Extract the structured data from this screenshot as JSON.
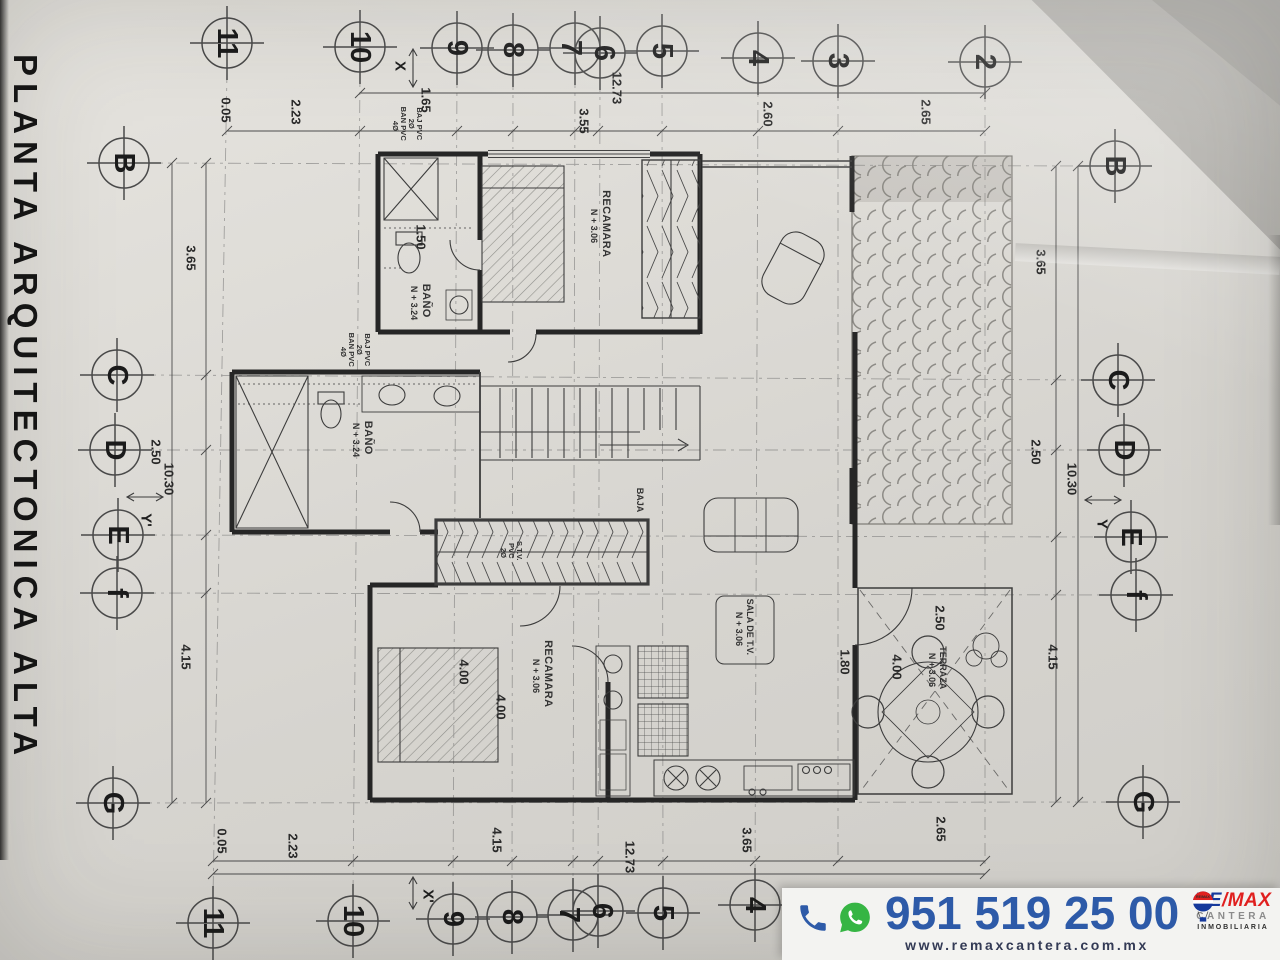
{
  "title": "PLANTA ARQUITECTONICA ALTA",
  "grid": {
    "top": [
      "11",
      "10",
      "9",
      "8",
      "7",
      "6",
      "5",
      "4",
      "3",
      "2"
    ],
    "bottom": [
      "11",
      "10",
      "9",
      "8",
      "7",
      "6",
      "5",
      "4"
    ],
    "left": [
      "B",
      "C",
      "D",
      "E",
      "f",
      "G"
    ],
    "right": [
      "B",
      "C",
      "D",
      "E",
      "f",
      "G"
    ],
    "axes": {
      "x_top": "X",
      "x_bottom": "X'",
      "y_left": "Y'",
      "y_right": "Y"
    }
  },
  "dims": {
    "top": [
      "0.05",
      "2.23",
      "1.65",
      "12.73",
      "3.55",
      "2.60",
      "2.65"
    ],
    "left": [
      "3.65",
      "2.50",
      "10.30",
      "4.15"
    ],
    "right": [
      "3.65",
      "2.50",
      "10.30",
      "4.15"
    ],
    "bottom": [
      "0.05",
      "2.23",
      "4.15",
      "12.73",
      "3.65",
      "2.65"
    ],
    "interior": [
      "1.50",
      "4.00",
      "4.00",
      "1.80",
      "2.50",
      "4.00"
    ]
  },
  "rooms": {
    "recamara1": {
      "name": "RECAMARA",
      "level": "N + 3.06"
    },
    "bano1": {
      "name": "BAÑO",
      "level": "N + 3.24"
    },
    "bano2": {
      "name": "BAÑO",
      "level": "N + 3.24"
    },
    "recamara2": {
      "name": "RECAMARA",
      "level": "N + 3.06"
    },
    "sala_tv": {
      "name": "SALA DE T.V.",
      "level": "N + 3.06"
    },
    "terraza": {
      "name": "TERRAZA",
      "level": "N + 3.06"
    },
    "stairs": "BAJA"
  },
  "plumbing": {
    "baj": "BAJ PVC",
    "baj_dia": "2Ø",
    "ban": "BAN PVC",
    "ban_dia": "4Ø",
    "stv1": "S.T.V.",
    "stv2": "PVC",
    "stv3": "2Ø"
  },
  "banner": {
    "phone": "951 519 25 00",
    "website": "www.remaxcantera.com.mx",
    "logo": {
      "balloon": "RE/MAX",
      "re": "RE",
      "slash": "/",
      "max": "MAX",
      "line2": "CANTERA",
      "line3": "INMOBILIARIA"
    },
    "colors": {
      "phone_blue": "#2d5aa8",
      "whatsapp_green": "#36b544",
      "remax_blue": "#16399c",
      "remax_red": "#e0201f",
      "cantera_gray": "#8b8b8b"
    }
  }
}
